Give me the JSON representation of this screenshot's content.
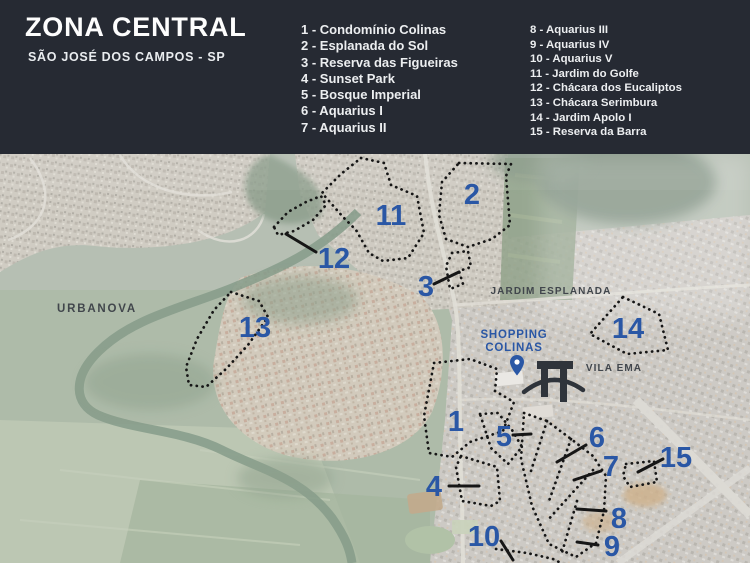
{
  "header": {
    "title": "ZONA CENTRAL",
    "subtitle": "SÃO JOSÉ DOS CAMPOS - SP",
    "legend_col1": [
      "1 - Condomínio Colinas",
      "2 - Esplanada do Sol",
      "3 - Reserva das Figueiras",
      "4 - Sunset Park",
      "5 - Bosque Imperial",
      "6 - Aquarius I",
      "7 - Aquarius II"
    ],
    "legend_col2": [
      "8 - Aquarius III",
      "9 - Aquarius IV",
      "10 - Aquarius V",
      "11 - Jardim do Golfe",
      "12 - Chácara dos Eucaliptos",
      "13 - Chácara Serimbura",
      "14 - Jardim Apolo I",
      "15 - Reserva da Barra"
    ]
  },
  "map": {
    "place_labels": {
      "urbanova": "URBANOVA",
      "jardim_esplanada": "JARDIM ESPLANADA",
      "vila_ema": "VILA EMA",
      "shopping_line1": "SHOPPING",
      "shopping_line2": "COLINAS"
    },
    "numbers": [
      "1",
      "2",
      "3",
      "4",
      "5",
      "6",
      "7",
      "8",
      "9",
      "10",
      "11",
      "12",
      "13",
      "14",
      "15"
    ],
    "colors": {
      "header_bg": "#262a33",
      "number_blue": "#2a57a5",
      "label_dark": "#41464c",
      "outline_black": "#161616",
      "pin_blue": "#2a57a5"
    }
  }
}
